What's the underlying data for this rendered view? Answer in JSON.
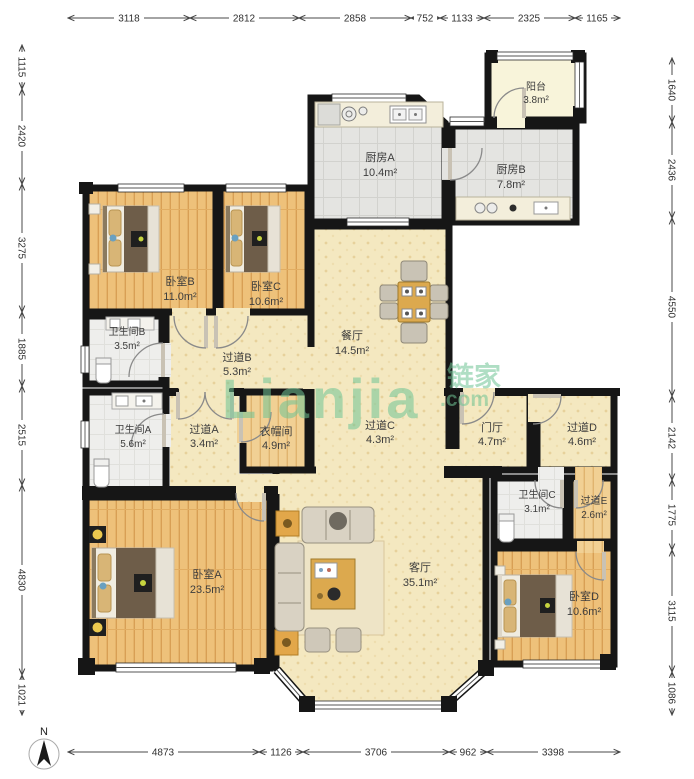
{
  "title": "apartment-floor-plan",
  "watermark": {
    "logo": "Lianjia",
    "cn": "链家",
    "com": ".com"
  },
  "compass": {
    "label": "N"
  },
  "dimensions": {
    "top": [
      "3118",
      "2812",
      "2858",
      "752",
      "1133",
      "2325",
      "1165"
    ],
    "left": [
      "1115",
      "2420",
      "3275",
      "1885",
      "2515",
      "4830",
      "1021"
    ],
    "right": [
      "1640",
      "2436",
      "4550",
      "2142",
      "1775",
      "3115",
      "1086"
    ],
    "bottom": [
      "4873",
      "1126",
      "3706",
      "962",
      "3398"
    ]
  },
  "rooms": {
    "balcony": {
      "name": "阳台",
      "area": "3.8m²"
    },
    "kitchen_a": {
      "name": "厨房A",
      "area": "10.4m²"
    },
    "kitchen_b": {
      "name": "厨房B",
      "area": "7.8m²"
    },
    "bedroom_b": {
      "name": "卧室B",
      "area": "11.0m²"
    },
    "bedroom_c": {
      "name": "卧室C",
      "area": "10.6m²"
    },
    "bathroom_b": {
      "name": "卫生间B",
      "area": "3.5m²"
    },
    "corridor_b": {
      "name": "过道B",
      "area": "5.3m²"
    },
    "dining": {
      "name": "餐厅",
      "area": "14.5m²"
    },
    "bathroom_a": {
      "name": "卫生间A",
      "area": "5.6m²"
    },
    "corridor_a": {
      "name": "过道A",
      "area": "3.4m²"
    },
    "cloakroom": {
      "name": "衣帽间",
      "area": "4.9m²"
    },
    "corridor_c": {
      "name": "过道C",
      "area": "4.3m²"
    },
    "hall": {
      "name": "门厅",
      "area": "4.7m²"
    },
    "corridor_d": {
      "name": "过道D",
      "area": "4.6m²"
    },
    "bathroom_c": {
      "name": "卫生间C",
      "area": "3.1m²"
    },
    "corridor_e": {
      "name": "过道E",
      "area": "2.6m²"
    },
    "bedroom_a": {
      "name": "卧室A",
      "area": "23.5m²"
    },
    "living": {
      "name": "客厅",
      "area": "35.1m²"
    },
    "bedroom_d": {
      "name": "卧室D",
      "area": "10.6m²"
    }
  },
  "colors": {
    "wall": "#161616",
    "wood_floor": "#eec17a",
    "tile_beige": "#f4e8c0",
    "kitchen_gray": "#e4e4e1",
    "bath_gray": "#eeeeec",
    "balcony_cream": "#f8f4da",
    "watermark_green": "#6fc495"
  }
}
